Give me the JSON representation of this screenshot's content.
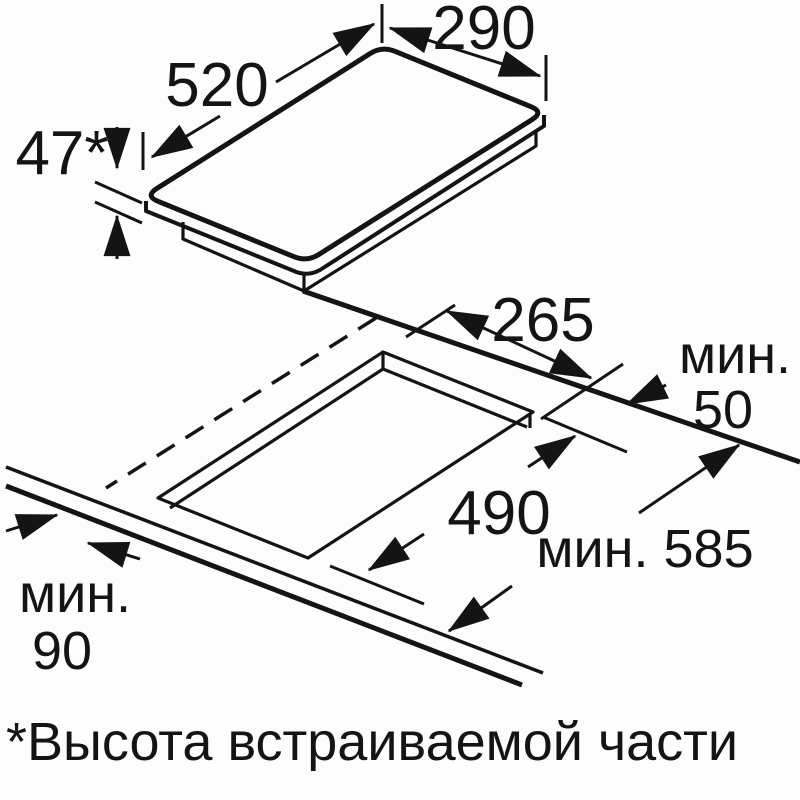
{
  "diagram": {
    "appliance": {
      "length_label": "520",
      "width_label": "290",
      "builtin_height_label": "47*"
    },
    "cutout": {
      "width_label": "265",
      "length_label": "490"
    },
    "clearances": {
      "rear_prefix": "мин.",
      "rear_value": "50",
      "worktop_depth_label": "мин. 585",
      "front_prefix": "мин.",
      "front_value": "90"
    },
    "footnote": "*Высота встраиваемой части",
    "colors": {
      "line": "#141414",
      "background": "#fdfdfd"
    }
  }
}
